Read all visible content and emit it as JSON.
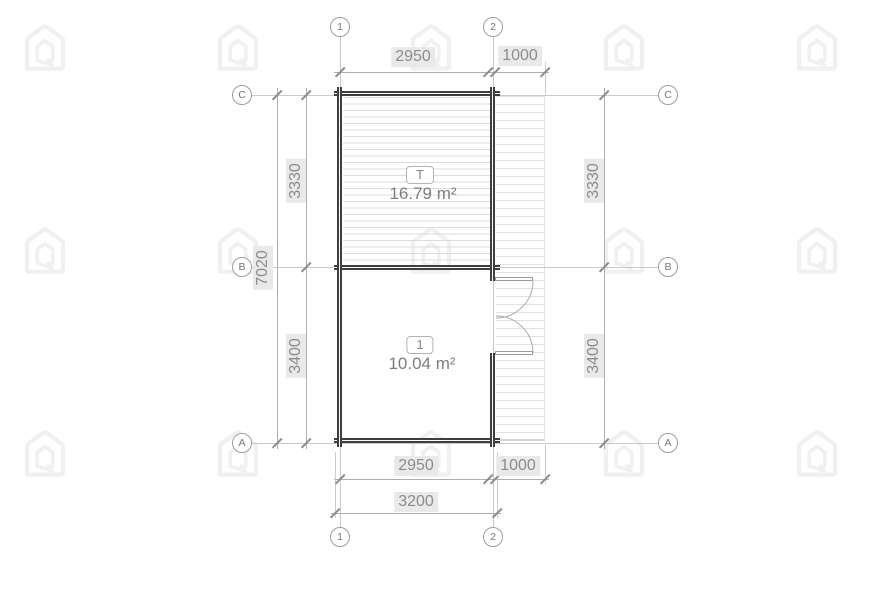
{
  "colors": {
    "wall": "#3e3e3e",
    "grid_line": "#c9c9c9",
    "dim_line": "#aeaeae",
    "ext_line": "#cccccc",
    "tick": "#8a8a8a",
    "dim_text": "#8c8c8c",
    "dim_label_bg": "#e9e9e9",
    "hatch": "#dcdcdc",
    "watermark": "#f0f0f0"
  },
  "watermark": {
    "icon": "house-logo-watermark",
    "color": "#f0f0f0"
  },
  "grid": {
    "columns": [
      {
        "label": "1"
      },
      {
        "label": "2"
      }
    ],
    "rows": [
      {
        "label": "C"
      },
      {
        "label": "B"
      },
      {
        "label": "A"
      }
    ]
  },
  "dimensions": {
    "top": {
      "segments": [
        "2950",
        "1000"
      ]
    },
    "bottom": {
      "segments": [
        "2950",
        "1000"
      ],
      "overall": "3200"
    },
    "left": {
      "overall": "7020",
      "segments": [
        "3330",
        "3400"
      ]
    },
    "right": {
      "segments": [
        "3330",
        "3400"
      ]
    }
  },
  "rooms": [
    {
      "tag": "T",
      "area": "16.79 m²"
    },
    {
      "tag": "1",
      "area": "10.04 m²"
    }
  ]
}
